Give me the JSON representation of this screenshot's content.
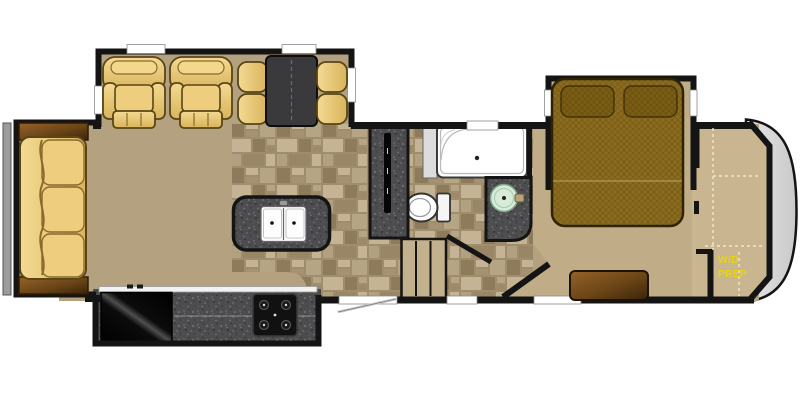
{
  "labels": {
    "wd_prep_line1": "W/D",
    "wd_prep_line2": "PREP"
  },
  "colors": {
    "wall": "#141414",
    "floor_main": "#b3a17f",
    "floor_bedroom": "#c0ad87",
    "floor_closet": "#c9b690",
    "tile_base": "#a08d6c",
    "tile_light": "#c4b394",
    "tile_dark": "#8e7b5c",
    "upholstery": "#ecca79",
    "upholstery_outline": "#5a4516",
    "wood_cabinet": "#7a4e1d",
    "bed_spread": "#8b6b1e",
    "granite_counter": "#4d4d4f",
    "appliance_black": "#0d0d0d",
    "fixture_white": "#ffffff",
    "vanity_sink_green": "#d6ecd8",
    "label_yellow": "#e9d50a",
    "front_cap_gray": "#d9d9d9",
    "slide_bar_gray": "#9c9c9c",
    "dinette_table": "#3a3a3c"
  }
}
